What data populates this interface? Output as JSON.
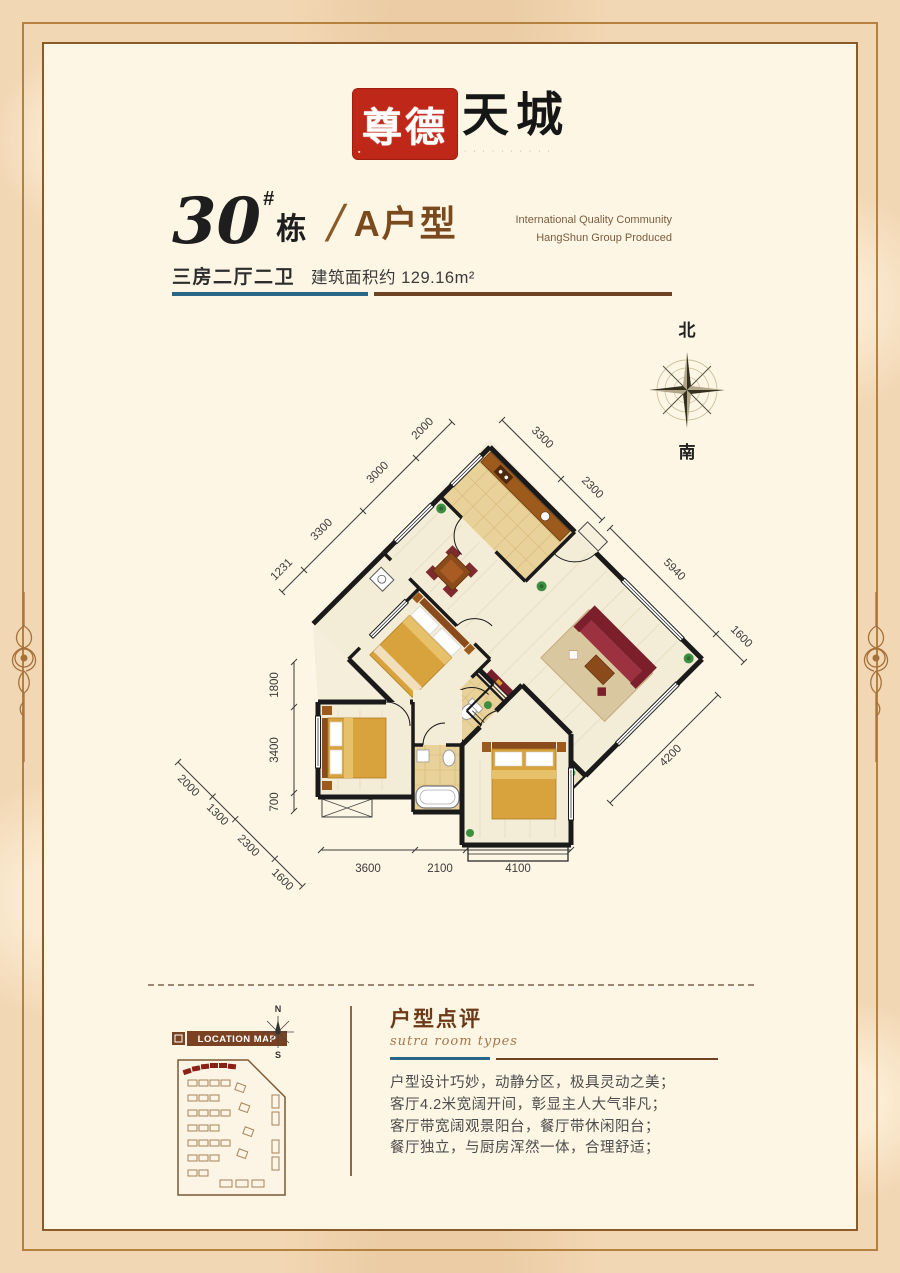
{
  "brand": {
    "seal": "尊德",
    "wordmark": "天城",
    "tagline": "· · · · · · · · · ·",
    "seal_mark": "▪"
  },
  "header": {
    "building_no": "30",
    "hash": "#",
    "unit_word": "栋",
    "divider": "/",
    "unit_type": "A户型",
    "eng_line1": "International Quality Community",
    "eng_line2": "HangShun Group Produced",
    "spec": "三房二厅二卫",
    "area_label": "建筑面积约",
    "area_value": "129.16m²"
  },
  "compass": {
    "north": "北",
    "south": "南"
  },
  "plan": {
    "dims": {
      "nw": [
        "1231",
        "3300",
        "3000",
        "2000"
      ],
      "ne": [
        "3300",
        "2300"
      ],
      "ne_far": [
        "5940",
        "1600"
      ],
      "se": [
        "4200"
      ],
      "west": [
        "1800",
        "3400",
        "700"
      ],
      "sw": [
        "2000",
        "1300",
        "2300",
        "1600"
      ],
      "south": [
        "3600",
        "2100",
        "4100"
      ]
    }
  },
  "location_map": {
    "badge": "LOCATION MAP",
    "north": "N",
    "south": "S"
  },
  "review": {
    "title": "户型点评",
    "subtitle": "sutra room types",
    "lines": [
      "户型设计巧妙，动静分区，极具灵动之美；",
      "客厅4.2米宽阔开间，彰显主人大气非凡；",
      "客厅带宽阔观景阳台，餐厅带休闲阳台；",
      "餐厅独立，与厨房浑然一体，合理舒适；"
    ]
  },
  "colors": {
    "accent_teal": "#2a6686",
    "accent_brown": "#6e4322",
    "seal_red": "#bf2718",
    "wall": "#1a1a1a",
    "bed_gold": "#d8a33c"
  }
}
